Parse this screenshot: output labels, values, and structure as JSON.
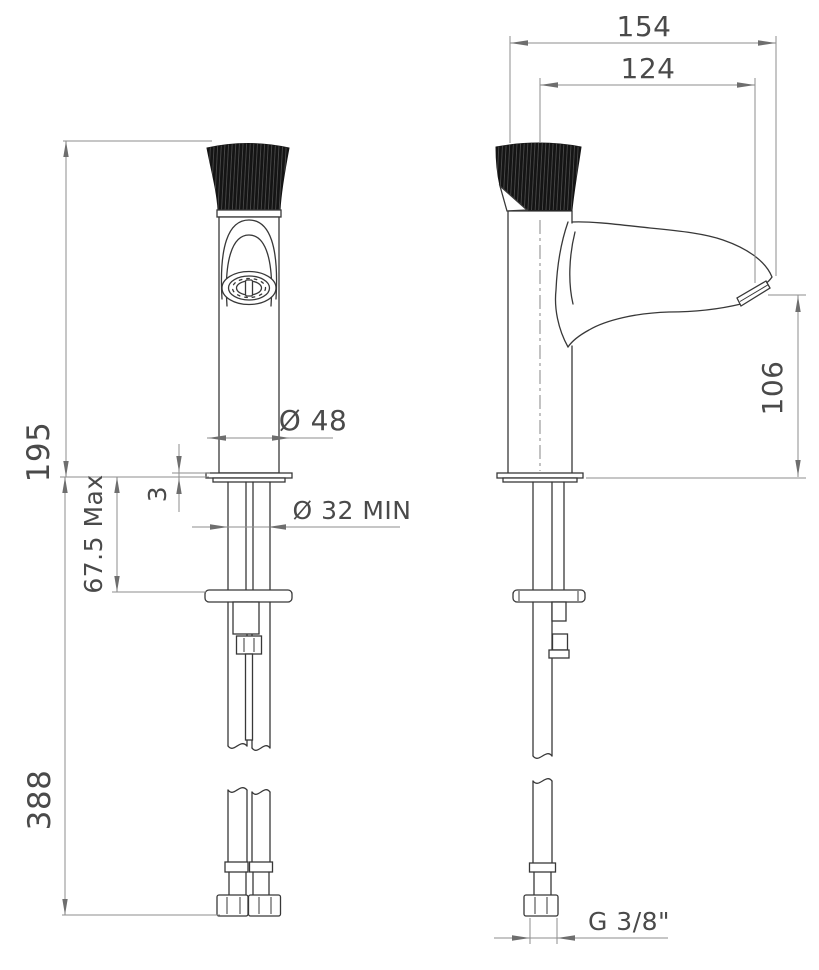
{
  "dimensions": {
    "front": {
      "overall_height": "195",
      "deck_thickness": "3",
      "max_deck_thickness": "67.5 Max",
      "hose_length": "388",
      "base_diameter": "Ø 48",
      "min_hole_diameter": "Ø 32  MIN"
    },
    "side": {
      "overall_reach": "154",
      "outlet_reach": "124",
      "outlet_height": "106",
      "connection_thread": "G  3/8\""
    }
  }
}
